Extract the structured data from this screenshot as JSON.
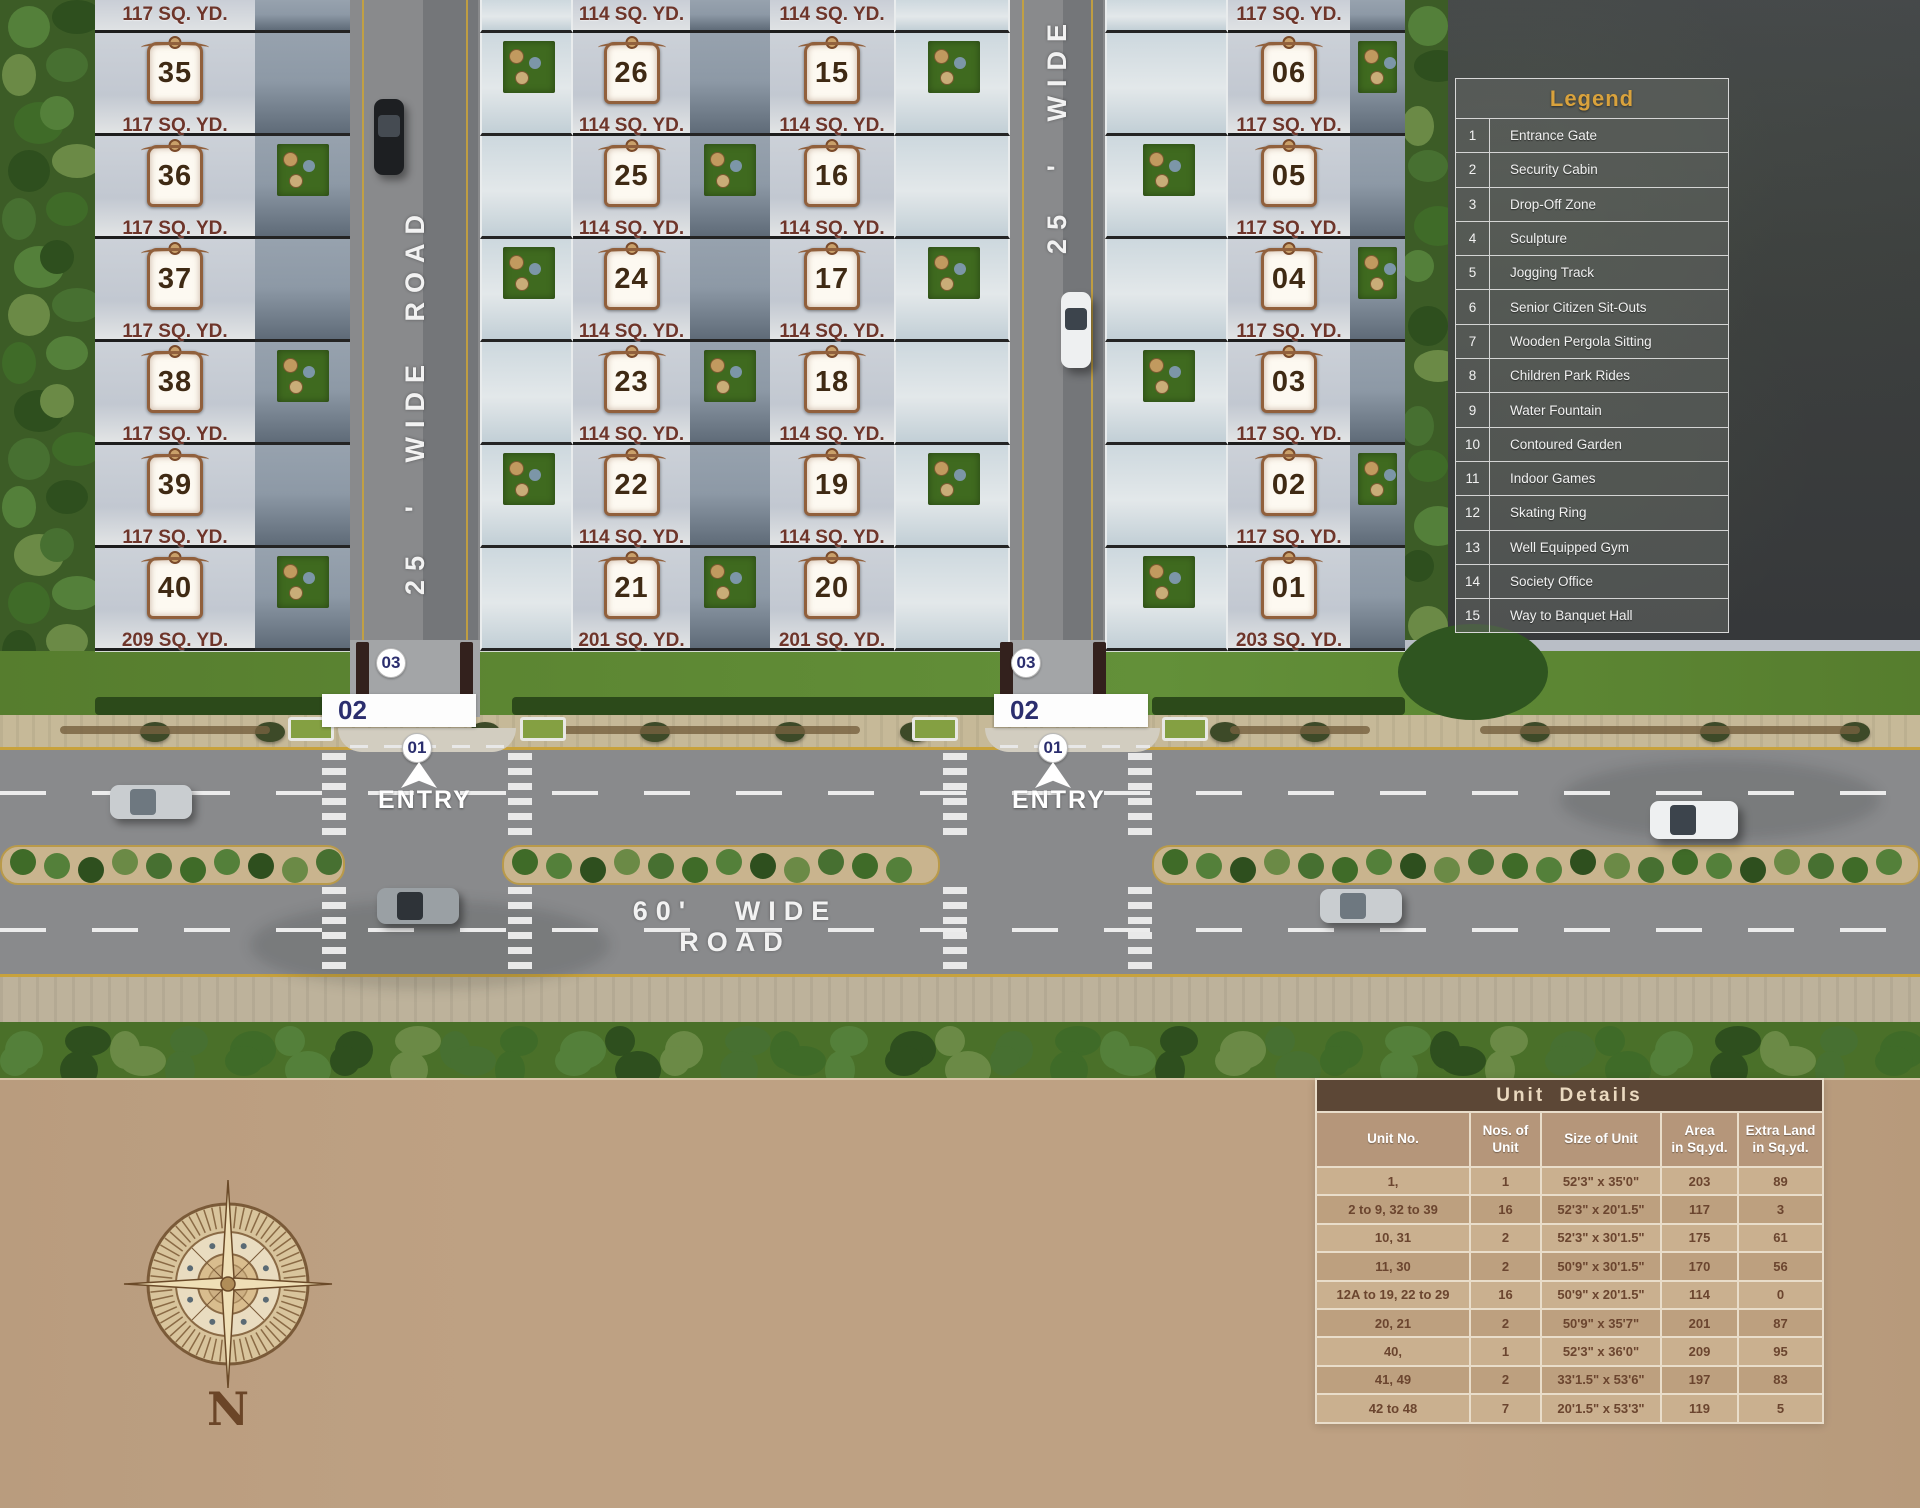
{
  "colors": {
    "legend_title": "#D9A23C",
    "entry_number_navy": "#2B2E6E",
    "area_label_maroon": "#6E352A",
    "plaque_number_brown": "#3F2A14",
    "road_text_white": "#F2F2F2",
    "tan_background": "#BEA183",
    "table_title_bar": "#5C4736",
    "table_cell_text": "#6B452F",
    "road_asphalt": "#898A8C",
    "yellow_edge_line": "#C8A23C"
  },
  "site_plan": {
    "roads": {
      "road_left_label": "25 ' WIDE ROAD",
      "road_right_label": "25 ' WIDE",
      "main_road_label": "60' WIDE ROAD"
    },
    "entry": {
      "gate_label": "01",
      "cabin_label": "02",
      "dropoff_label": "03",
      "entry_text": "ENTRY"
    },
    "compass_label": "N",
    "columns": [
      {
        "id": "units-35-40",
        "top_partial_area": "117 SQ. YD.",
        "units": [
          {
            "number": "35",
            "area": "117 SQ. YD."
          },
          {
            "number": "36",
            "area": "117 SQ. YD."
          },
          {
            "number": "37",
            "area": "117 SQ. YD."
          },
          {
            "number": "38",
            "area": "117 SQ. YD."
          },
          {
            "number": "39",
            "area": "117 SQ. YD."
          },
          {
            "number": "40",
            "area": "209 SQ. YD."
          }
        ]
      },
      {
        "id": "units-26-21",
        "top_partial_area": "114 SQ. YD.",
        "units": [
          {
            "number": "26",
            "area": "114 SQ. YD."
          },
          {
            "number": "25",
            "area": "114 SQ. YD."
          },
          {
            "number": "24",
            "area": "114 SQ. YD."
          },
          {
            "number": "23",
            "area": "114 SQ. YD."
          },
          {
            "number": "22",
            "area": "114 SQ. YD."
          },
          {
            "number": "21",
            "area": "201 SQ. YD."
          }
        ]
      },
      {
        "id": "units-15-20",
        "top_partial_area": "114 SQ. YD.",
        "units": [
          {
            "number": "15",
            "area": "114 SQ. YD."
          },
          {
            "number": "16",
            "area": "114 SQ. YD."
          },
          {
            "number": "17",
            "area": "114 SQ. YD."
          },
          {
            "number": "18",
            "area": "114 SQ. YD."
          },
          {
            "number": "19",
            "area": "114 SQ. YD."
          },
          {
            "number": "20",
            "area": "201 SQ. YD."
          }
        ]
      },
      {
        "id": "units-06-01",
        "top_partial_area": "117 SQ. YD.",
        "units": [
          {
            "number": "06",
            "area": "117 SQ. YD."
          },
          {
            "number": "05",
            "area": "117 SQ. YD."
          },
          {
            "number": "04",
            "area": "117 SQ. YD."
          },
          {
            "number": "03",
            "area": "117 SQ. YD."
          },
          {
            "number": "02",
            "area": "117 SQ. YD."
          },
          {
            "number": "01",
            "area": "203 SQ. YD."
          }
        ]
      }
    ]
  },
  "legend": {
    "title": "Legend",
    "items": [
      {
        "num": "1",
        "label": "Entrance Gate"
      },
      {
        "num": "2",
        "label": "Security Cabin"
      },
      {
        "num": "3",
        "label": "Drop-Off Zone"
      },
      {
        "num": "4",
        "label": "Sculpture"
      },
      {
        "num": "5",
        "label": "Jogging Track"
      },
      {
        "num": "6",
        "label": "Senior Citizen Sit-Outs"
      },
      {
        "num": "7",
        "label": "Wooden Pergola Sitting"
      },
      {
        "num": "8",
        "label": "Children Park Rides"
      },
      {
        "num": "9",
        "label": "Water Fountain"
      },
      {
        "num": "10",
        "label": "Contoured Garden"
      },
      {
        "num": "11",
        "label": "Indoor Games"
      },
      {
        "num": "12",
        "label": "Skating Ring"
      },
      {
        "num": "13",
        "label": "Well Equipped Gym"
      },
      {
        "num": "14",
        "label": "Society Office"
      },
      {
        "num": "15",
        "label": "Way to Banquet Hall"
      }
    ]
  },
  "unit_details": {
    "title": "Unit  Details",
    "headers": [
      "Unit No.",
      "Nos. of\nUnit",
      "Size of Unit",
      "Area\nin Sq.yd.",
      "Extra Land\nin Sq.yd."
    ],
    "rows": [
      [
        "1,",
        "1",
        "52'3\" x 35'0\"",
        "203",
        "89"
      ],
      [
        "2 to 9, 32 to 39",
        "16",
        "52'3\" x 20'1.5\"",
        "117",
        "3"
      ],
      [
        "10, 31",
        "2",
        "52'3\" x 30'1.5\"",
        "175",
        "61"
      ],
      [
        "11, 30",
        "2",
        "50'9\" x 30'1.5\"",
        "170",
        "56"
      ],
      [
        "12A to 19, 22 to 29",
        "16",
        "50'9\" x 20'1.5\"",
        "114",
        "0"
      ],
      [
        "20, 21",
        "2",
        "50'9\" x 35'7\"",
        "201",
        "87"
      ],
      [
        "40,",
        "1",
        "52'3\" x 36'0\"",
        "209",
        "95"
      ],
      [
        "41, 49",
        "2",
        "33'1.5\" x 53'6\"",
        "197",
        "83"
      ],
      [
        "42 to 48",
        "7",
        "20'1.5\" x 53'3\"",
        "119",
        "5"
      ]
    ]
  }
}
